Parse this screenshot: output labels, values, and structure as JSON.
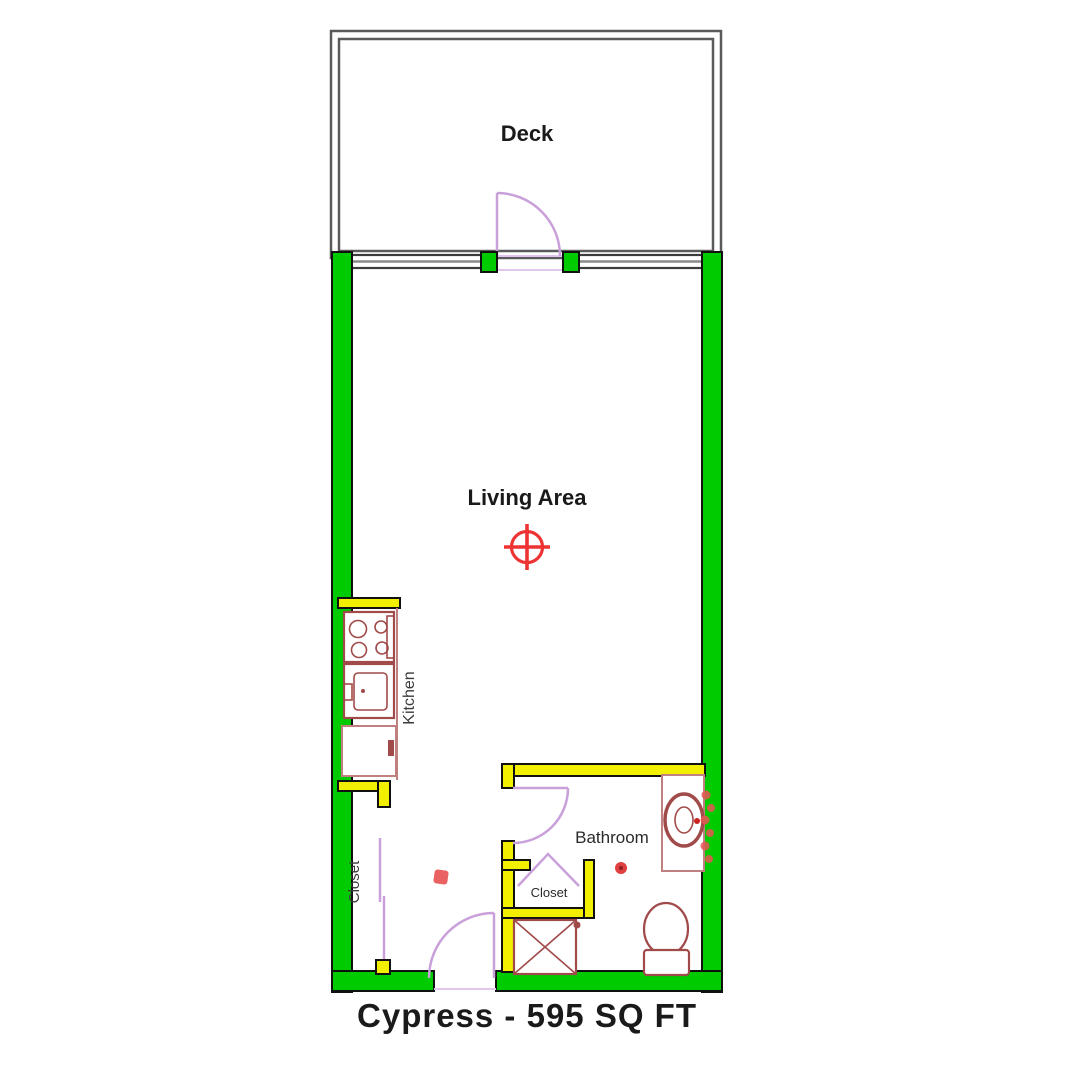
{
  "title": "Cypress - 595 SQ FT",
  "labels": {
    "deck": "Deck",
    "living_area": "Living Area",
    "kitchen": "Kitchen",
    "bathroom": "Bathroom",
    "closet_main": "Closet",
    "closet_bath": "Closet"
  },
  "colors": {
    "wall-green": "#00cb00",
    "interior-yellow": "#f2ef00",
    "door-purple": "#c9a0d9",
    "door-purple-light": "#e2c6ee",
    "fixture-red": "#a14a4a",
    "fixture-red-light": "#c08080",
    "symbol-red": "#ee3333",
    "deck-gray": "#5a5a5a",
    "window-gray": "#8a8a8a",
    "outline-black": "#111111",
    "text-black": "#1a1a1a"
  }
}
